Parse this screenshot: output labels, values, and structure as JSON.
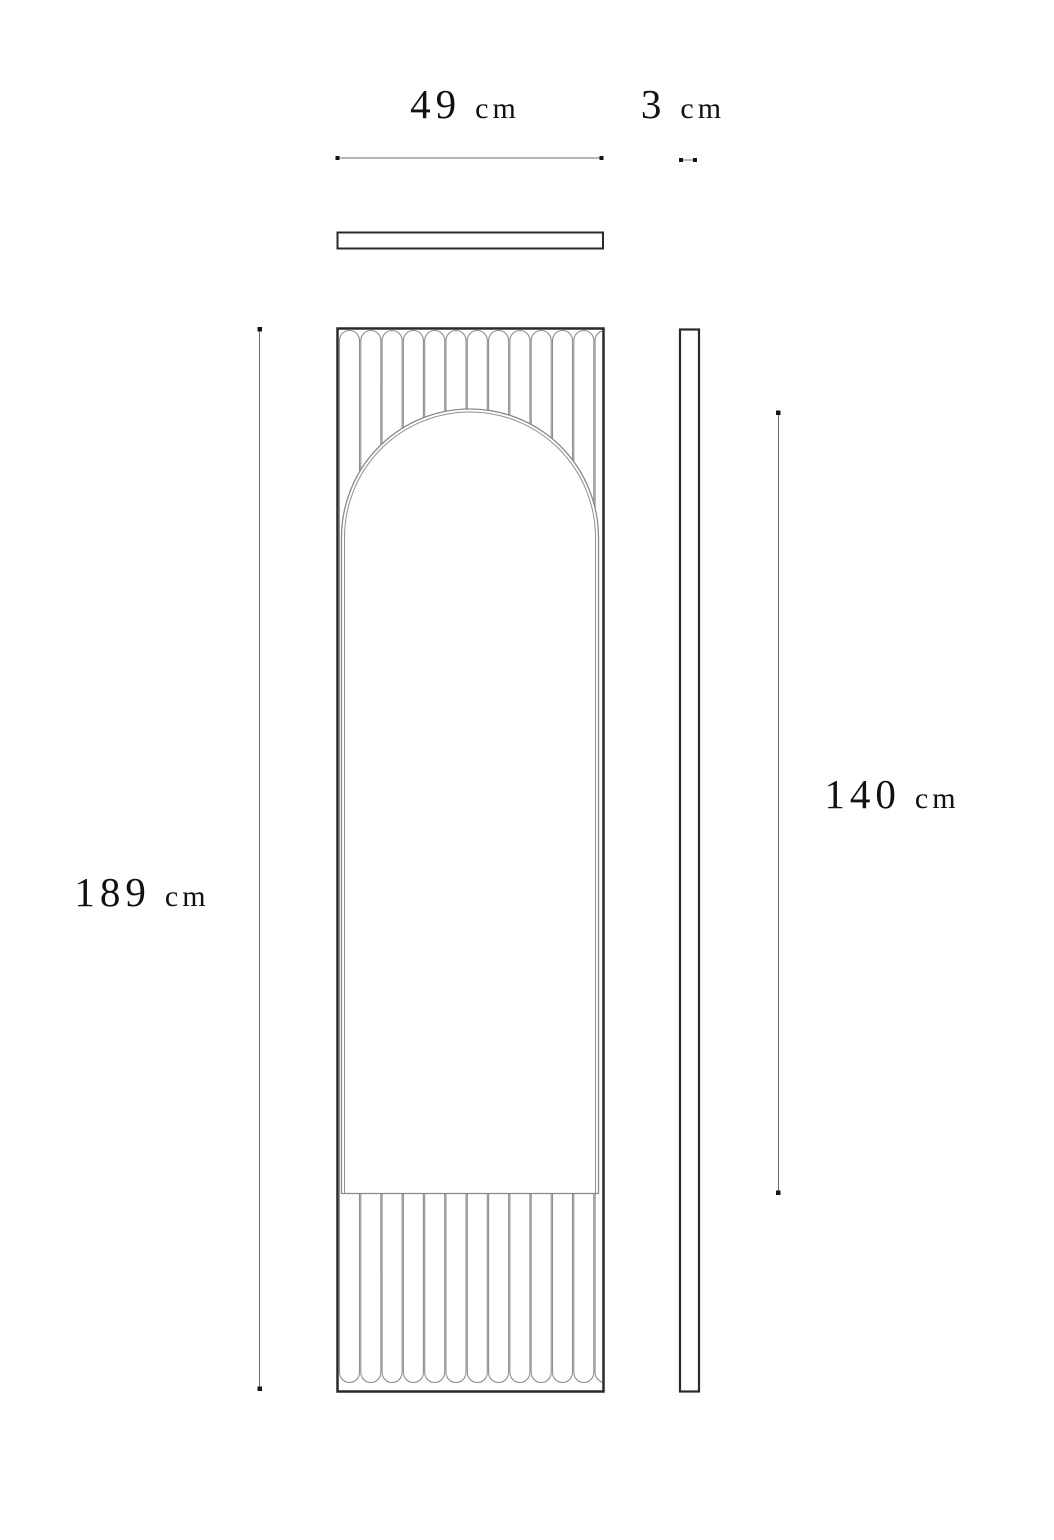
{
  "labels": {
    "width": {
      "value": "49",
      "unit": "cm"
    },
    "depth": {
      "value": "3",
      "unit": "cm"
    },
    "height": {
      "value": "189",
      "unit": "cm"
    },
    "mirror_height": {
      "value": "140",
      "unit": "cm"
    }
  },
  "colors": {
    "background": "#ffffff",
    "outline_dark": "#2a2a2a",
    "detail_gray": "#8f8f8f",
    "dimension_line": "#6b6b6b",
    "dimension_dot": "#151515",
    "text": "#111111"
  },
  "drawing": {
    "type": "furniture dimensional drawing",
    "views": [
      "top view",
      "front view",
      "side view"
    ]
  }
}
